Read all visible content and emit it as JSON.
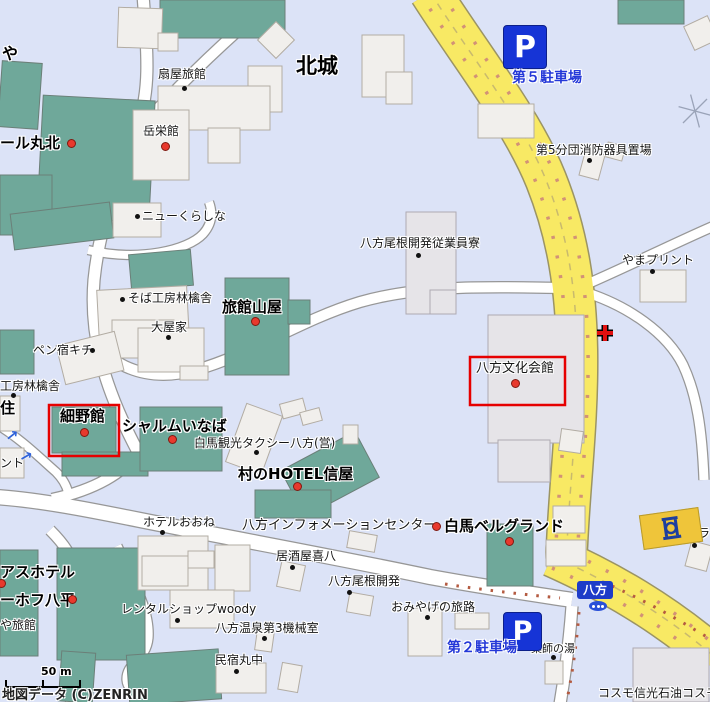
{
  "map": {
    "colors": {
      "bg": "#dce3f7",
      "teal": "#6fa89a",
      "white_bldg": "#f1efec",
      "gray_bldg": "#e6e4e8",
      "road_fill": "#ffffff",
      "road_casing": "#979797",
      "yellow_fill": "#f8e964",
      "yellow_casing": "#9b9464",
      "yellow_center": "#c9ba6d",
      "yellow_dot": "#d29276",
      "red": "#e60000",
      "red_dot": "#e8392d",
      "black_dot": "#111111",
      "parking_blue": "#1634d6",
      "label_blue": "#2438d8",
      "sign_blue": "#1e3cc8",
      "boundary_dot": "#b45b41"
    },
    "labels": [
      {
        "t": "や",
        "x": 2,
        "y": 46,
        "s": 16,
        "b": 1
      },
      {
        "t": "北城",
        "x": 296,
        "y": 56,
        "s": 21,
        "b": 1
      },
      {
        "t": "扇屋旅館",
        "x": 158,
        "y": 68,
        "s": 12,
        "b": 0,
        "d": [
          184,
          88,
          "k"
        ]
      },
      {
        "t": "岳栄館",
        "x": 143,
        "y": 125,
        "s": 12,
        "b": 0,
        "d": [
          165,
          146,
          "r"
        ]
      },
      {
        "t": "ール丸北",
        "x": 0,
        "y": 136,
        "s": 15,
        "b": 1,
        "d": [
          71,
          143,
          "r"
        ]
      },
      {
        "t": "ニューくらしな",
        "x": 142,
        "y": 210,
        "s": 12,
        "b": 0,
        "d": [
          137,
          216,
          "k"
        ]
      },
      {
        "t": "八方尾根開発従業員寮",
        "x": 360,
        "y": 237,
        "s": 12,
        "b": 0,
        "d": [
          418,
          255,
          "k"
        ]
      },
      {
        "t": "第5分団消防器具置場",
        "x": 536,
        "y": 144,
        "s": 12,
        "b": 0,
        "d": [
          589,
          160,
          "k"
        ]
      },
      {
        "t": "やまプリント",
        "x": 622,
        "y": 254,
        "s": 12,
        "b": 0,
        "d": [
          652,
          271,
          "k"
        ]
      },
      {
        "t": "そば工房林檎舎",
        "x": 128,
        "y": 292,
        "s": 12,
        "b": 0,
        "d": [
          122,
          299,
          "k"
        ]
      },
      {
        "t": "大屋家",
        "x": 151,
        "y": 321,
        "s": 12,
        "b": 0,
        "d": [
          168,
          337,
          "k"
        ]
      },
      {
        "t": "旅館山屋",
        "x": 222,
        "y": 300,
        "s": 15,
        "b": 1,
        "d": [
          255,
          321,
          "r"
        ]
      },
      {
        "t": "ペン宿キチ",
        "x": 33,
        "y": 344,
        "s": 12,
        "b": 0,
        "d": [
          92,
          350,
          "k"
        ]
      },
      {
        "t": "工房林檎舎",
        "x": 0,
        "y": 380,
        "s": 12,
        "b": 0,
        "d": [
          13,
          395,
          "k"
        ]
      },
      {
        "t": "住",
        "x": 0,
        "y": 401,
        "s": 15,
        "b": 1
      },
      {
        "t": "ント",
        "x": 0,
        "y": 457,
        "s": 12,
        "b": 0
      },
      {
        "t": "八方文化会館",
        "x": 476,
        "y": 362,
        "s": 13,
        "b": 0,
        "d": [
          515,
          383,
          "r"
        ]
      },
      {
        "t": "細野館",
        "x": 60,
        "y": 409,
        "s": 15,
        "b": 1,
        "d": [
          84,
          432,
          "r"
        ]
      },
      {
        "t": "シャルムいなば",
        "x": 122,
        "y": 419,
        "s": 15,
        "b": 1,
        "d": [
          172,
          439,
          "r"
        ]
      },
      {
        "t": "白馬観光タクシー八方(営)",
        "x": 194,
        "y": 437,
        "s": 12,
        "b": 0,
        "d": [
          256,
          452,
          "k"
        ]
      },
      {
        "t": "村のHOTEL信屋",
        "x": 238,
        "y": 467,
        "s": 15,
        "b": 1,
        "d": [
          297,
          486,
          "r"
        ]
      },
      {
        "t": "ホテルおおね",
        "x": 143,
        "y": 516,
        "s": 12,
        "b": 0,
        "d": [
          162,
          532,
          "k"
        ]
      },
      {
        "t": "八方インフォメーションセンター",
        "x": 242,
        "y": 519,
        "s": 13,
        "b": 0,
        "d": [
          436,
          526,
          "r"
        ]
      },
      {
        "t": "白馬ベルグランド",
        "x": 444,
        "y": 519,
        "s": 15,
        "b": 1,
        "d": [
          509,
          541,
          "r"
        ]
      },
      {
        "t": "居酒屋喜八",
        "x": 276,
        "y": 550,
        "s": 12,
        "b": 0,
        "d": [
          292,
          567,
          "k"
        ]
      },
      {
        "t": "八方尾根開発",
        "x": 328,
        "y": 575,
        "s": 12,
        "b": 0,
        "d": [
          349,
          592,
          "k"
        ]
      },
      {
        "t": "おみやげの旅路",
        "x": 391,
        "y": 601,
        "s": 12,
        "b": 0,
        "d": [
          427,
          617,
          "k"
        ]
      },
      {
        "t": "薬師の湯",
        "x": 531,
        "y": 643,
        "s": 11,
        "b": 0,
        "d": [
          553,
          657,
          "k"
        ]
      },
      {
        "t": "エンダラジ",
        "x": 662,
        "y": 527,
        "s": 12,
        "b": 0,
        "d": [
          694,
          545,
          "k"
        ]
      },
      {
        "t": "アスホテル",
        "x": 0,
        "y": 565,
        "s": 15,
        "b": 1,
        "d": [
          1,
          583,
          "r"
        ]
      },
      {
        "t": "ーホフ八平",
        "x": 0,
        "y": 593,
        "s": 15,
        "b": 1,
        "d": [
          72,
          599,
          "r"
        ]
      },
      {
        "t": "や旅館",
        "x": 0,
        "y": 619,
        "s": 12,
        "b": 0
      },
      {
        "t": "レンタルショップwoody",
        "x": 121,
        "y": 603,
        "s": 12,
        "b": 0,
        "d": [
          177,
          620,
          "k"
        ]
      },
      {
        "t": "八方温泉第3機械室",
        "x": 215,
        "y": 622,
        "s": 12,
        "b": 0,
        "d": [
          264,
          638,
          "k"
        ]
      },
      {
        "t": "民宿丸中",
        "x": 215,
        "y": 654,
        "s": 12,
        "b": 0,
        "d": [
          236,
          671,
          "k"
        ]
      },
      {
        "t": "コスモ信光石油コスモ八",
        "x": 598,
        "y": 687,
        "s": 12,
        "b": 0
      }
    ],
    "parking": [
      {
        "p": "P",
        "label": "第５駐車場",
        "icon": [
          503,
          25,
          42
        ],
        "lx": 512,
        "ly": 71
      },
      {
        "p": "P",
        "label": "第２駐車場",
        "icon": [
          503,
          612,
          37
        ],
        "lx": 447,
        "ly": 641
      }
    ],
    "road_sign": {
      "text": "八方",
      "x": 577,
      "y": 581
    },
    "signal": {
      "x": 589,
      "y": 601,
      "w": 18,
      "h": 10
    },
    "cross": {
      "x": 605,
      "y": 333
    },
    "star": {
      "x": 695,
      "y": 111
    },
    "info_icon": {
      "x": 641,
      "y": 511,
      "w": 58,
      "h": 33,
      "rot": -8
    },
    "arrows": [
      {
        "x": 6,
        "y": 428,
        "rot": -38
      },
      {
        "x": 20,
        "y": 449,
        "rot": -30
      }
    ],
    "highlight_boxes": [
      {
        "x": 49,
        "y": 405,
        "w": 70,
        "h": 51
      },
      {
        "x": 470,
        "y": 357,
        "w": 95,
        "h": 48
      }
    ],
    "roads": {
      "white": [
        {
          "d": "M143,-5 C148,60 150,90 138,125 C120,175 100,220 94,280 C90,330 100,380 138,452",
          "w": 11
        },
        {
          "d": "M140,128 C170,95 210,55 250,20 L264,-5",
          "w": 10
        },
        {
          "d": "M88,250 C140,262 188,250 203,234 C212,224 213,213 209,202",
          "w": 8
        },
        {
          "d": "M96,345 C120,370 152,382 196,370 C250,355 300,320 360,302 C430,282 510,288 578,288",
          "w": 10
        },
        {
          "d": "M578,288 C625,268 668,246 714,226",
          "w": 9
        },
        {
          "d": "M578,290 C630,305 668,335 683,365 C697,395 702,430 704,480",
          "w": 9
        },
        {
          "d": "M-4,497 C40,500 90,510 140,520 C240,540 330,556 430,577 C490,588 540,595 572,600",
          "w": 14
        },
        {
          "d": "M138,452 C125,472 95,490 52,499",
          "w": 10
        },
        {
          "d": "M-4,424 C20,438 40,458 56,472 C62,478 66,484 68,492",
          "w": 8
        },
        {
          "d": "M50,530 C62,542 74,556 78,580 C82,615 74,660 71,704",
          "w": 10
        },
        {
          "d": "M117,546 C135,585 150,612 148,638 C146,660 126,663 127,680 C128,694 148,697 165,704",
          "w": 9
        },
        {
          "d": "M572,606 C570,635 566,668 560,704",
          "w": 11
        }
      ],
      "yellow": [
        "M430,-8 C470,55 522,120 546,180 C568,235 576,290 577,350 C578,420 570,480 567,545 C566,556 567,562 569,568",
        "M552,556 C610,582 662,612 716,658"
      ],
      "yellow_w": 40,
      "boundary": [
        "M445,584 C490,591 530,595 560,598",
        "M579,612 C577,640 573,670 567,700",
        "M612,586 C652,604 682,622 712,640"
      ]
    },
    "buildings": [
      [
        160,
        0,
        125,
        38,
        0,
        "t"
      ],
      [
        618,
        0,
        66,
        24,
        0,
        "t"
      ],
      [
        0,
        62,
        40,
        66,
        4,
        "t"
      ],
      [
        40,
        98,
        112,
        122,
        3,
        "t"
      ],
      [
        0,
        175,
        52,
        60,
        0,
        "t"
      ],
      [
        12,
        208,
        100,
        36,
        -7,
        "t"
      ],
      [
        130,
        252,
        62,
        36,
        -5,
        "t"
      ],
      [
        0,
        330,
        34,
        44,
        0,
        "t"
      ],
      [
        225,
        278,
        64,
        97,
        0,
        "t"
      ],
      [
        288,
        300,
        22,
        24,
        0,
        "t"
      ],
      [
        52,
        407,
        64,
        46,
        0,
        "t"
      ],
      [
        62,
        452,
        86,
        24,
        0,
        "t"
      ],
      [
        140,
        407,
        82,
        64,
        0,
        "t"
      ],
      [
        288,
        448,
        84,
        52,
        -28,
        "t"
      ],
      [
        487,
        524,
        46,
        62,
        0,
        "t"
      ],
      [
        255,
        490,
        76,
        28,
        0,
        "t"
      ],
      [
        0,
        550,
        38,
        106,
        0,
        "t"
      ],
      [
        57,
        548,
        88,
        112,
        0,
        "t"
      ],
      [
        128,
        652,
        92,
        50,
        -4,
        "t"
      ],
      [
        60,
        652,
        34,
        50,
        4,
        "t"
      ],
      [
        118,
        8,
        44,
        40,
        2,
        "w"
      ],
      [
        158,
        33,
        20,
        18,
        0,
        "w"
      ],
      [
        362,
        35,
        42,
        62,
        0,
        "w"
      ],
      [
        386,
        72,
        26,
        32,
        0,
        "w"
      ],
      [
        478,
        104,
        56,
        34,
        0,
        "w"
      ],
      [
        248,
        66,
        34,
        46,
        0,
        "w"
      ],
      [
        263,
        27,
        26,
        26,
        45,
        "w"
      ],
      [
        688,
        20,
        26,
        26,
        -25,
        "w"
      ],
      [
        158,
        86,
        112,
        44,
        0,
        "w"
      ],
      [
        133,
        110,
        56,
        70,
        0,
        "w"
      ],
      [
        208,
        128,
        32,
        35,
        0,
        "w"
      ],
      [
        113,
        203,
        48,
        34,
        0,
        "w"
      ],
      [
        406,
        212,
        50,
        102,
        0,
        "g"
      ],
      [
        430,
        290,
        26,
        24,
        0,
        "g"
      ],
      [
        98,
        288,
        90,
        52,
        -3,
        "w"
      ],
      [
        112,
        320,
        62,
        38,
        0,
        "w"
      ],
      [
        138,
        328,
        66,
        44,
        0,
        "w"
      ],
      [
        180,
        366,
        28,
        14,
        0,
        "w"
      ],
      [
        60,
        338,
        60,
        40,
        -14,
        "w"
      ],
      [
        0,
        396,
        20,
        35,
        0,
        "w"
      ],
      [
        0,
        448,
        24,
        30,
        0,
        "w"
      ],
      [
        235,
        408,
        38,
        62,
        20,
        "w"
      ],
      [
        281,
        401,
        24,
        15,
        -15,
        "w"
      ],
      [
        301,
        410,
        20,
        13,
        -15,
        "w"
      ],
      [
        343,
        425,
        15,
        19,
        0,
        "w"
      ],
      [
        488,
        315,
        96,
        128,
        0,
        "g"
      ],
      [
        498,
        440,
        52,
        42,
        0,
        "g"
      ],
      [
        560,
        430,
        22,
        22,
        8,
        "w"
      ],
      [
        138,
        536,
        70,
        54,
        0,
        "w"
      ],
      [
        215,
        545,
        35,
        46,
        0,
        "w"
      ],
      [
        348,
        533,
        28,
        17,
        10,
        "w"
      ],
      [
        279,
        563,
        24,
        26,
        12,
        "w"
      ],
      [
        348,
        594,
        24,
        20,
        10,
        "w"
      ],
      [
        408,
        608,
        34,
        48,
        0,
        "w"
      ],
      [
        455,
        613,
        34,
        16,
        0,
        "w"
      ],
      [
        553,
        506,
        32,
        27,
        0,
        "w"
      ],
      [
        546,
        540,
        40,
        26,
        0,
        "w"
      ],
      [
        688,
        543,
        22,
        26,
        15,
        "w"
      ],
      [
        545,
        661,
        18,
        23,
        0,
        "w"
      ],
      [
        633,
        648,
        76,
        54,
        0,
        "g"
      ],
      [
        216,
        663,
        50,
        30,
        0,
        "w"
      ],
      [
        280,
        664,
        20,
        27,
        10,
        "w"
      ],
      [
        170,
        590,
        64,
        38,
        0,
        "w"
      ],
      [
        142,
        556,
        46,
        30,
        0,
        "w"
      ],
      [
        188,
        551,
        26,
        17,
        0,
        "w"
      ],
      [
        256,
        630,
        17,
        21,
        8,
        "w"
      ],
      [
        582,
        152,
        20,
        26,
        15,
        "w"
      ],
      [
        606,
        144,
        18,
        15,
        15,
        "w"
      ],
      [
        640,
        270,
        46,
        32,
        0,
        "w"
      ]
    ],
    "scale": {
      "text": "50 m"
    },
    "copyright": "地図データ (C)ZENRIN"
  }
}
